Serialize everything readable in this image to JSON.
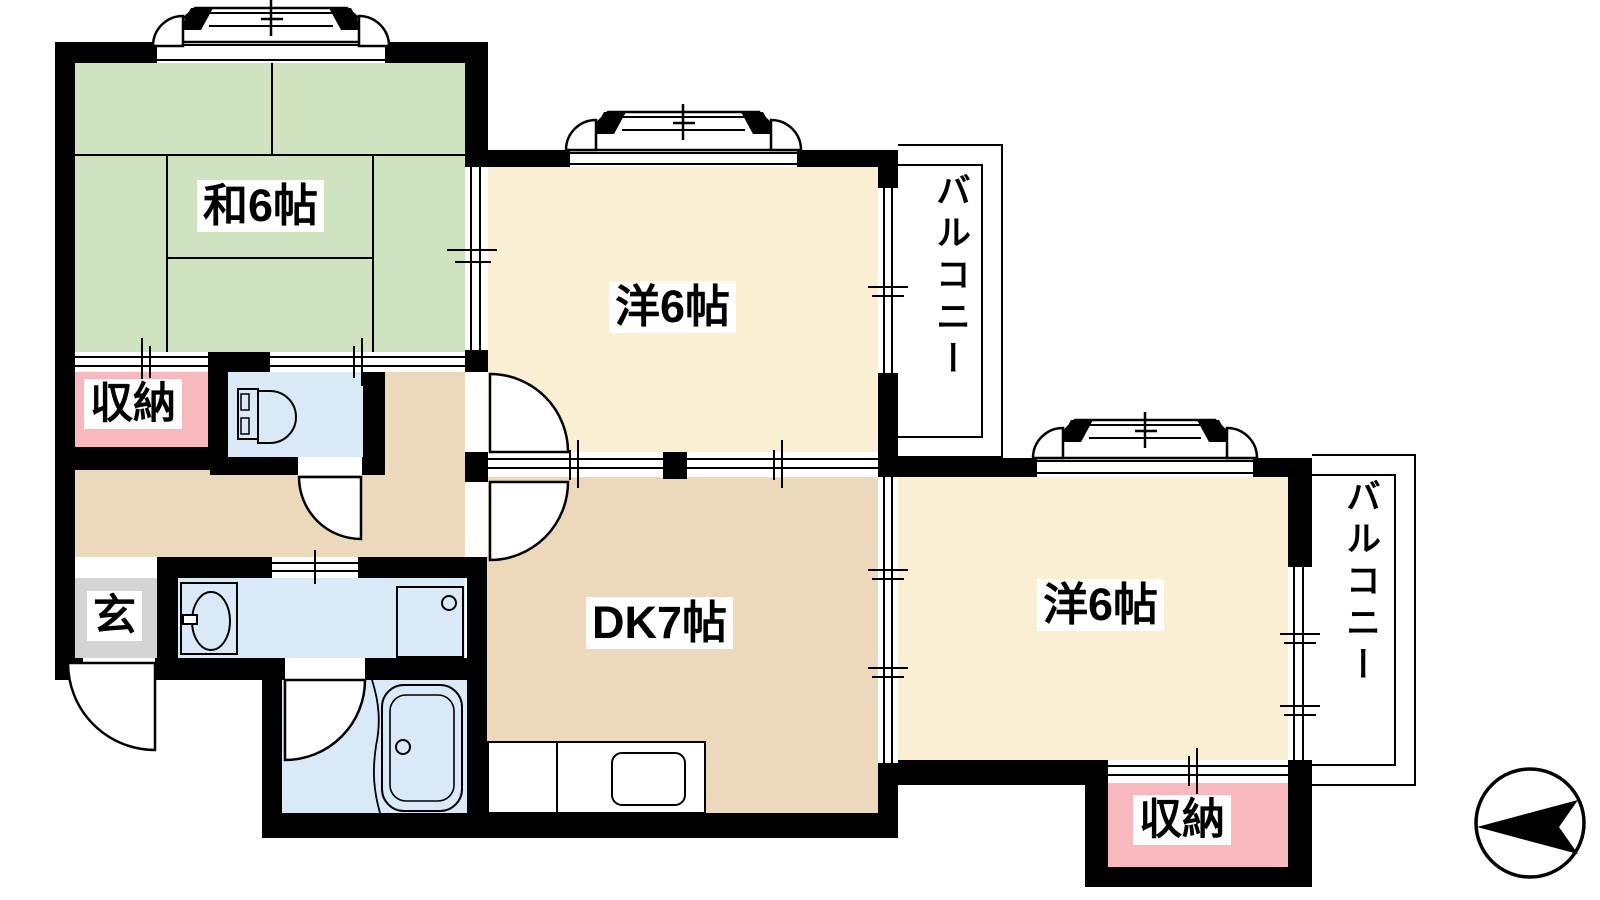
{
  "rooms": {
    "japanese_room": {
      "label": "和6帖"
    },
    "western_room_top": {
      "label": "洋6帖"
    },
    "western_room_right": {
      "label": "洋6帖"
    },
    "dining_kitchen": {
      "label": "DK7帖"
    },
    "storage_left": {
      "label": "収納"
    },
    "storage_right": {
      "label": "収納"
    },
    "entrance": {
      "label": "玄"
    },
    "balcony_top": {
      "label": "バルコニー"
    },
    "balcony_right": {
      "label": "バルコニー"
    }
  },
  "colors": {
    "tatami_green": "#cfe3c1",
    "bedroom_cream": "#faefd3",
    "dk_tan": "#ecd9bb",
    "storage_pink": "#f7b9bd",
    "wet_area_blue": "#d9e9f8",
    "entrance_gray": "#d4d4d4",
    "wall_black": "#000000",
    "line_black": "#000000"
  }
}
